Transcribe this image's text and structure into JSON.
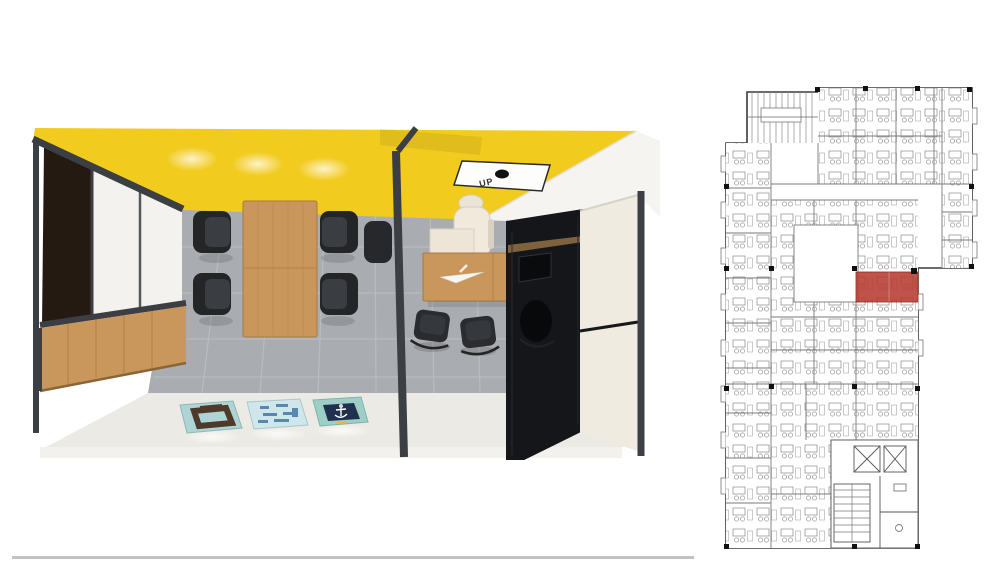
{
  "page": {
    "background_color": "#ffffff"
  },
  "scene_render": {
    "kind": "3d-interior-top-down-render",
    "ceiling_sign_label": "UP",
    "colors": {
      "ceiling_yellow": "#f2cb1f",
      "ceiling_yellow_shadow": "#dcb414",
      "wood": "#c9975c",
      "dark_frame": "#3b3e43",
      "floor_gray": "#a9acb0",
      "floor_white": "#eceae4",
      "chair_black": "#2b2d30",
      "wardrobe_cream": "#f0ebe1",
      "glossy_black": "#141619",
      "dark_doorway": "#241a12",
      "poster1_teal": "#aed4d6",
      "poster2_blue": "#cfe6ea",
      "poster3_teal": "#9ecfc6",
      "poster3_navy": "#223050"
    }
  },
  "floor_plan": {
    "kind": "architectural-floor-plan",
    "highlight_room_color": "#b63b30",
    "line_color": "#7a7a7a",
    "outline_color": "#3a3a3a"
  },
  "footer": {
    "divider_color": "#c2c2c2"
  }
}
